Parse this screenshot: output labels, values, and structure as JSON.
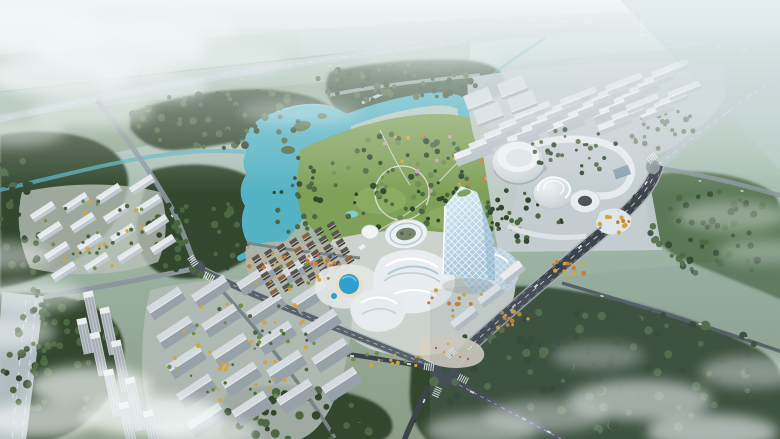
{
  "meta": {
    "description": "Aerial architectural rendering of a mixed-use masterplan: turquoise lake park, central glass tower with ring building and mall podium, cylindrical civic center, residential slab clusters, road network, forests and low clouds"
  },
  "palette": {
    "sky_top": "#c9dadd",
    "sky_mid": "#b0c5bb",
    "field_mid": "#9ab1a0",
    "field_dark": "#8a9c85",
    "field_light": "#aebfb0",
    "field_pale": "#b7c8c0",
    "horizon": "#d3e2e4",
    "forest_dark": "#31472f",
    "forest_mid": "#4b6841",
    "forest_light": "#6d8c4f",
    "lake": "#53b2c3",
    "lake_light": "#86cfd9",
    "road_light": "#b7c4c8",
    "road_mid": "#8b979d",
    "road_dark": "#3c444b",
    "lane": "#eef2f3",
    "sidewalk": "#a9b4b8",
    "bldg_roof": "#e9edf0",
    "bldg_facade": "#b6c0c6",
    "glass_light": "#d8e9f3",
    "glass_mid": "#a6c7dc",
    "park": "#7fa057",
    "lawn": "#8fae66",
    "paving": "#cfd6d9",
    "plaza": "#d8d2c2",
    "pool": "#2f9fce",
    "deck": "#e9dfc8",
    "cloud": "#f6fafa",
    "tree_yellow": "#d2a440",
    "tree_orange": "#c77f35",
    "blossom": "#cf9fba",
    "drum_hi": "#f0f3f4",
    "drum_lo": "#c2ccd1"
  },
  "scene": {
    "clusters": [
      {
        "name": "apartments-top-right",
        "origin": [
          472,
          150
        ],
        "cols": 4,
        "rows": 5,
        "colv": [
          46,
          -14
        ],
        "rowv": [
          15,
          -10
        ],
        "w": 38,
        "h": 6,
        "fh": 7.5,
        "fhStep": -0.9,
        "angle": -21,
        "roof": "#e9edf0",
        "facade": "#b6c0c6",
        "fade": 0.07
      },
      {
        "name": "apartments-top-right-east",
        "origin": [
          614,
          122
        ],
        "cols": 2,
        "rows": 3,
        "colv": [
          42,
          -13
        ],
        "rowv": [
          14,
          -10
        ],
        "w": 34,
        "h": 5.5,
        "fh": 5,
        "fhStep": -0.6,
        "angle": -21,
        "roof": "#e7ebee",
        "facade": "#b9c3c9",
        "fade": 0.1
      },
      {
        "name": "halls-west",
        "origin": [
          478,
          98
        ],
        "cols": 2,
        "rows": 2,
        "colv": [
          34,
          -12
        ],
        "rowv": [
          10,
          15
        ],
        "w": 27,
        "h": 14,
        "fh": 3,
        "fhStep": 0,
        "angle": -21,
        "roof": "#d6dde1",
        "facade": "#a9b3b9",
        "fade": 0.05
      },
      {
        "name": "residential-left-upper",
        "origin": [
          42,
          210
        ],
        "cols": 4,
        "rows": 4,
        "colv": [
          33,
          -9
        ],
        "rowv": [
          7,
          20
        ],
        "w": 26,
        "h": 5,
        "fh": 4,
        "fhStep": 0,
        "angle": -33,
        "roof": "#e4e9ec",
        "facade": "#bfc9ce",
        "fade": 0
      },
      {
        "name": "residential-left-lower",
        "origin": [
          164,
          300
        ],
        "cols": 4,
        "rows": 5,
        "colv": [
          45,
          -12
        ],
        "rowv": [
          10,
          29
        ],
        "w": 38,
        "h": 7.5,
        "fh": 8,
        "fhStep": 0.7,
        "angle": -33,
        "roof": "#d4dadd",
        "facade": "#97a2a8",
        "fade": 0
      }
    ],
    "village": {
      "origin": [
        256,
        258
      ],
      "cols": 7,
      "rows": 5,
      "colv": [
        12.5,
        -5.5
      ],
      "rowv": [
        4.5,
        8.5
      ],
      "w": 8,
      "h": 4.5,
      "fh": 1.8,
      "angle": -33,
      "roof": "#5b554e",
      "facade": "#3f3b36",
      "alt": "#8a6440"
    },
    "towers": {
      "angle": -12,
      "w": 10,
      "roof": "#eaeef0",
      "facade": "#a3adb3",
      "items": [
        [
          92,
          312,
          42
        ],
        [
          109,
          331,
          48
        ],
        [
          99,
          354,
          44
        ],
        [
          121,
          366,
          52
        ],
        [
          113,
          393,
          48
        ],
        [
          135,
          404,
          54
        ],
        [
          128,
          425,
          46
        ],
        [
          152,
          431,
          42
        ],
        [
          85,
          336,
          36
        ]
      ]
    },
    "treeRegions": [
      {
        "cx": 405,
        "cy": 182,
        "rx": 80,
        "ry": 50,
        "n": 85,
        "c": [
          "#31472f",
          "#4b6841",
          "#6d8c4f"
        ],
        "r": [
          1.5,
          3.2
        ],
        "layer": "back"
      },
      {
        "cx": 428,
        "cy": 166,
        "rx": 62,
        "ry": 36,
        "n": 16,
        "c": [
          "#cf9fba",
          "#c77f35",
          "#d2a440"
        ],
        "r": [
          1.4,
          2.4
        ],
        "layer": "back"
      },
      {
        "cx": 296,
        "cy": 196,
        "rx": 26,
        "ry": 40,
        "n": 24,
        "c": [
          "#31472f",
          "#4b6841"
        ],
        "r": [
          1.5,
          3
        ],
        "layer": "back"
      },
      {
        "cx": 225,
        "cy": 118,
        "rx": 95,
        "ry": 30,
        "n": 75,
        "c": [
          "#31472f",
          "#4b6841"
        ],
        "r": [
          2,
          4
        ],
        "layer": "back"
      },
      {
        "cx": 400,
        "cy": 82,
        "rx": 85,
        "ry": 20,
        "n": 55,
        "c": [
          "#31472f",
          "#4b6841"
        ],
        "r": [
          1.8,
          3.4
        ],
        "layer": "back"
      },
      {
        "cx": 20,
        "cy": 212,
        "rx": 25,
        "ry": 72,
        "n": 42,
        "c": [
          "#31472f",
          "#4b6841"
        ],
        "r": [
          2,
          4
        ],
        "layer": "back"
      },
      {
        "cx": 196,
        "cy": 236,
        "rx": 48,
        "ry": 46,
        "n": 55,
        "c": [
          "#31472f",
          "#4b6841"
        ],
        "r": [
          2,
          4
        ],
        "layer": "back"
      },
      {
        "cx": 62,
        "cy": 362,
        "rx": 62,
        "ry": 62,
        "n": 70,
        "c": [
          "#31472f",
          "#4b6841"
        ],
        "r": [
          2.4,
          4.5
        ],
        "layer": "back"
      },
      {
        "cx": 305,
        "cy": 416,
        "rx": 82,
        "ry": 26,
        "n": 45,
        "c": [
          "#31472f",
          "#4b6841"
        ],
        "r": [
          2.4,
          4.5
        ],
        "layer": "back"
      },
      {
        "cx": 600,
        "cy": 372,
        "rx": 172,
        "ry": 66,
        "n": 150,
        "c": [
          "#2c402c",
          "#31472f",
          "#4b6841"
        ],
        "r": [
          2.4,
          5
        ],
        "layer": "back"
      },
      {
        "cx": 716,
        "cy": 236,
        "rx": 66,
        "ry": 46,
        "n": 55,
        "c": [
          "#4b6841",
          "#31472f"
        ],
        "r": [
          2,
          3.8
        ],
        "o": 0.85,
        "layer": "back"
      },
      {
        "cx": 520,
        "cy": 216,
        "rx": 44,
        "ry": 28,
        "n": 40,
        "c": [
          "#31472f",
          "#4b6841"
        ],
        "r": [
          1.5,
          3
        ],
        "layer": "back"
      },
      {
        "cx": 660,
        "cy": 130,
        "rx": 42,
        "ry": 22,
        "n": 24,
        "c": [
          "#4b6841"
        ],
        "r": [
          1.5,
          3
        ],
        "o": 0.6,
        "layer": "back"
      },
      {
        "cx": 35,
        "cy": 332,
        "rx": 15,
        "ry": 48,
        "n": 18,
        "c": [
          "#31472f",
          "#4b6841"
        ],
        "r": [
          2,
          3.4
        ],
        "layer": "back"
      },
      {
        "cx": 97,
        "cy": 232,
        "rx": 56,
        "ry": 38,
        "n": 36,
        "c": [
          "#6d8c4f",
          "#d2a440",
          "#4b6841"
        ],
        "r": [
          1.2,
          2.2
        ],
        "layer": "front"
      },
      {
        "cx": 246,
        "cy": 348,
        "rx": 82,
        "ry": 56,
        "n": 60,
        "c": [
          "#d2a440",
          "#6d8c4f",
          "#4b6841"
        ],
        "r": [
          1.2,
          2.4
        ],
        "layer": "front"
      },
      {
        "cx": 296,
        "cy": 272,
        "rx": 50,
        "ry": 20,
        "n": 28,
        "c": [
          "#d2a440",
          "#c77f35",
          "#6d8c4f"
        ],
        "r": [
          1.2,
          2.2
        ],
        "layer": "front"
      },
      {
        "cx": 512,
        "cy": 322,
        "rx": 18,
        "ry": 11,
        "n": 12,
        "c": [
          "#d2a440",
          "#c77f35"
        ],
        "r": [
          1.4,
          2.4
        ],
        "layer": "front"
      },
      {
        "cx": 568,
        "cy": 268,
        "rx": 18,
        "ry": 11,
        "n": 12,
        "c": [
          "#d2a440",
          "#c77f35"
        ],
        "r": [
          1.4,
          2.4
        ],
        "layer": "front"
      },
      {
        "cx": 615,
        "cy": 225,
        "rx": 16,
        "ry": 10,
        "n": 10,
        "c": [
          "#d2a440",
          "#c77f35"
        ],
        "r": [
          1.4,
          2.4
        ],
        "layer": "front"
      },
      {
        "cx": 390,
        "cy": 360,
        "rx": 46,
        "ry": 8,
        "n": 14,
        "c": [
          "#d2a440",
          "#6d8c4f"
        ],
        "r": [
          1.3,
          2.2
        ],
        "layer": "front"
      },
      {
        "cx": 455,
        "cy": 302,
        "rx": 30,
        "ry": 18,
        "n": 12,
        "c": [
          "#d2a440",
          "#c77f35"
        ],
        "r": [
          1.3,
          2.2
        ],
        "layer": "front"
      },
      {
        "cx": 575,
        "cy": 150,
        "rx": 45,
        "ry": 25,
        "n": 30,
        "c": [
          "#4b6841",
          "#31472f"
        ],
        "r": [
          1.4,
          2.6
        ],
        "layer": "front"
      }
    ],
    "cars": [
      [
        470,
        348,
        -40,
        "#f4f6f6",
        1
      ],
      [
        492,
        327,
        -40,
        "#383e44",
        1
      ],
      [
        514,
        306,
        -42,
        "#cfd4d6",
        1
      ],
      [
        536,
        286,
        -42,
        "#f4f6f6",
        1
      ],
      [
        558,
        266,
        -44,
        "#383e44",
        1
      ],
      [
        580,
        247,
        -44,
        "#f4f6f6",
        1
      ],
      [
        600,
        228,
        -46,
        "#9aa2a6",
        1
      ],
      [
        618,
        211,
        -48,
        "#f4f6f6",
        0.9
      ],
      [
        634,
        196,
        -50,
        "#383e44",
        0.9
      ],
      [
        646,
        183,
        -55,
        "#f4f6f6",
        0.9
      ],
      [
        472,
        392,
        27,
        "#f4f6f6",
        1
      ],
      [
        498,
        406,
        27,
        "#383e44",
        1
      ],
      [
        524,
        419,
        27,
        "#cfd4d6",
        1
      ],
      [
        549,
        432,
        27,
        "#f4f6f6",
        1
      ],
      [
        424,
        401,
        114,
        "#f4f6f6",
        0.9
      ],
      [
        415,
        421,
        114,
        "#383e44",
        0.9
      ],
      [
        352,
        356,
        8,
        "#f4f6f6",
        0.9
      ],
      [
        381,
        360,
        8,
        "#6b7378",
        0.9
      ],
      [
        409,
        364,
        8,
        "#f4f6f6",
        0.9
      ],
      [
        602,
        296,
        16,
        "#e8ecec",
        0.8
      ],
      [
        650,
        310,
        16,
        "#454c52",
        0.8
      ],
      [
        700,
        324,
        16,
        "#e8ecec",
        0.8
      ],
      [
        746,
        338,
        16,
        "#b9c0c3",
        0.8
      ],
      [
        26,
        320,
        -82,
        "#f4f6f6",
        0.9
      ],
      [
        19,
        358,
        -82,
        "#454c52",
        0.9
      ],
      [
        13,
        396,
        -82,
        "#e8ecec",
        0.9
      ],
      [
        152,
        182,
        55,
        "#dfe3e4",
        0.7
      ],
      [
        172,
        216,
        60,
        "#eceff0",
        0.7
      ],
      [
        162,
        94,
        -12,
        "#e8ecee",
        0.6
      ],
      [
        242,
        79,
        -12,
        "#dfe5e7",
        0.6
      ],
      [
        330,
        66,
        -12,
        "#e8ecee",
        0.6
      ],
      [
        728,
        112,
        -38,
        "#dde3e6",
        0.7
      ],
      [
        750,
        95,
        -38,
        "#eef2f3",
        0.7
      ],
      [
        700,
        181,
        10,
        "#dde3e6",
        0.7
      ],
      [
        742,
        191,
        10,
        "#eef2f3",
        0.7
      ]
    ],
    "crosswalks": [
      [
        451,
        353,
        -40
      ],
      [
        463,
        379,
        27
      ],
      [
        429,
        367,
        8
      ],
      [
        437,
        392,
        114
      ],
      [
        193,
        261,
        55
      ],
      [
        209,
        277,
        27
      ],
      [
        652,
        158,
        -40
      ]
    ],
    "specks": [
      [
        420,
        22,
        5
      ],
      [
        443,
        20,
        7
      ],
      [
        468,
        19,
        5
      ],
      [
        498,
        18,
        8
      ],
      [
        528,
        19,
        6
      ],
      [
        558,
        21,
        7
      ],
      [
        588,
        23,
        5
      ],
      [
        640,
        34,
        5
      ],
      [
        665,
        40,
        6
      ],
      [
        690,
        43,
        8
      ],
      [
        716,
        46,
        5
      ],
      [
        741,
        49,
        6
      ]
    ],
    "clouds": [
      [
        35,
        30,
        75,
        24,
        0.9
      ],
      [
        120,
        48,
        85,
        26,
        0.85
      ],
      [
        60,
        76,
        70,
        20,
        0.75
      ],
      [
        175,
        30,
        62,
        16,
        0.6
      ],
      [
        150,
        86,
        58,
        16,
        0.55
      ],
      [
        235,
        62,
        52,
        14,
        0.4
      ],
      [
        92,
        112,
        62,
        16,
        0.5
      ],
      [
        15,
        132,
        50,
        14,
        0.45
      ],
      [
        300,
        112,
        60,
        13,
        0.3
      ],
      [
        430,
        58,
        70,
        12,
        0.22
      ],
      [
        5,
        256,
        46,
        14,
        0.45
      ],
      [
        32,
        296,
        52,
        16,
        0.5
      ],
      [
        10,
        332,
        46,
        16,
        0.5
      ],
      [
        90,
        386,
        62,
        20,
        0.7
      ],
      [
        152,
        416,
        72,
        20,
        0.75
      ],
      [
        40,
        420,
        56,
        18,
        0.65
      ],
      [
        205,
        432,
        52,
        15,
        0.5
      ],
      [
        482,
        430,
        56,
        16,
        0.5
      ],
      [
        545,
        416,
        62,
        16,
        0.45
      ],
      [
        640,
        400,
        72,
        20,
        0.6
      ],
      [
        712,
        432,
        66,
        18,
        0.65
      ],
      [
        752,
        372,
        52,
        16,
        0.45
      ],
      [
        598,
        356,
        46,
        13,
        0.35
      ],
      [
        732,
        216,
        56,
        15,
        0.35
      ],
      [
        764,
        252,
        46,
        13,
        0.32
      ]
    ]
  }
}
